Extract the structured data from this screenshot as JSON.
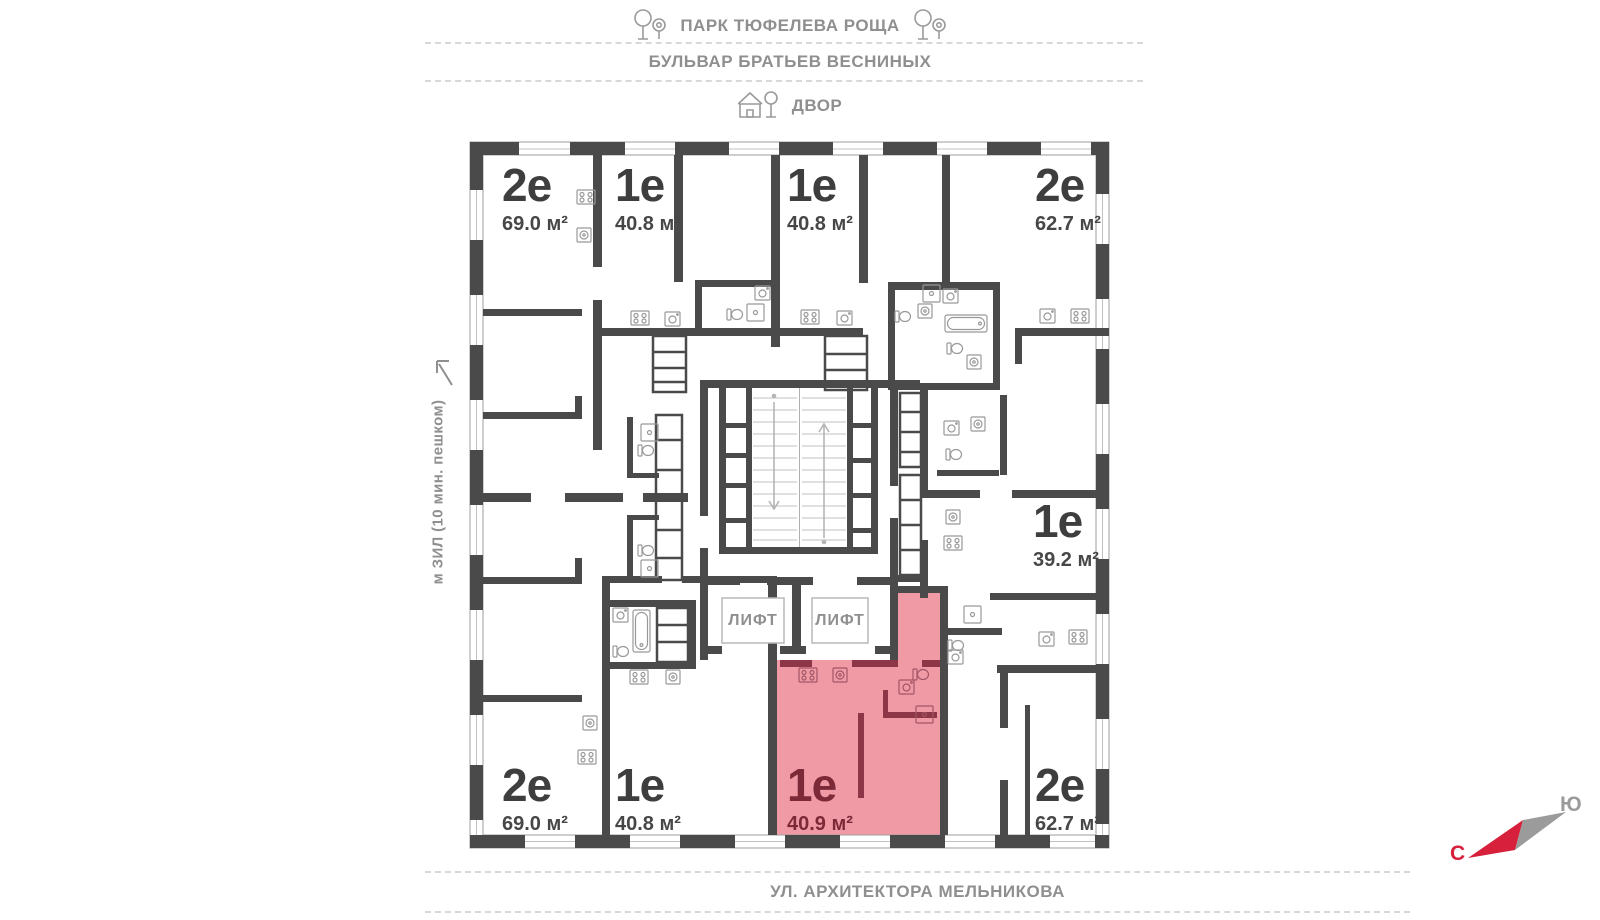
{
  "surroundings": {
    "park_label": "ПАРК ТЮФЕЛЕВА РОЩА",
    "boulevard_label": "БУЛЬВАР БРАТЬЕВ ВЕСНИНЫХ",
    "courtyard_label": "ДВОР",
    "street_label": "УЛ. АРХИТЕКТОРА МЕЛЬНИКОВА",
    "metro_label": "м ЗИЛ (10 мин. пешком)"
  },
  "compass": {
    "north_label": "С",
    "south_label": "Ю"
  },
  "lift_label": "ЛИФТ",
  "apartments": [
    {
      "id": "top-left",
      "type": "2е",
      "area": "69.0 м²",
      "highlighted": false
    },
    {
      "id": "top-mid-left",
      "type": "1е",
      "area": "40.8 м²",
      "highlighted": false
    },
    {
      "id": "top-mid-right",
      "type": "1е",
      "area": "40.8 м²",
      "highlighted": false
    },
    {
      "id": "top-right",
      "type": "2е",
      "area": "62.7 м²",
      "highlighted": false
    },
    {
      "id": "right",
      "type": "1е",
      "area": "39.2 м²",
      "highlighted": false
    },
    {
      "id": "bottom-right",
      "type": "2е",
      "area": "62.7 м²",
      "highlighted": false
    },
    {
      "id": "bottom-center",
      "type": "1е",
      "area": "40.9 м²",
      "highlighted": true
    },
    {
      "id": "bottom-mid-left",
      "type": "1е",
      "area": "40.8 м²",
      "highlighted": false
    },
    {
      "id": "bottom-left",
      "type": "2е",
      "area": "69.0 м²",
      "highlighted": false
    }
  ],
  "colors": {
    "wall": "#4a4a4a",
    "highlight_fill": "#f09aa6",
    "highlight_wall": "#8d3647",
    "highlight_text": "#7c2a38",
    "street_text": "#8f8f8f",
    "compass_north": "#d6203c",
    "compass_south": "#9b9b9b"
  }
}
